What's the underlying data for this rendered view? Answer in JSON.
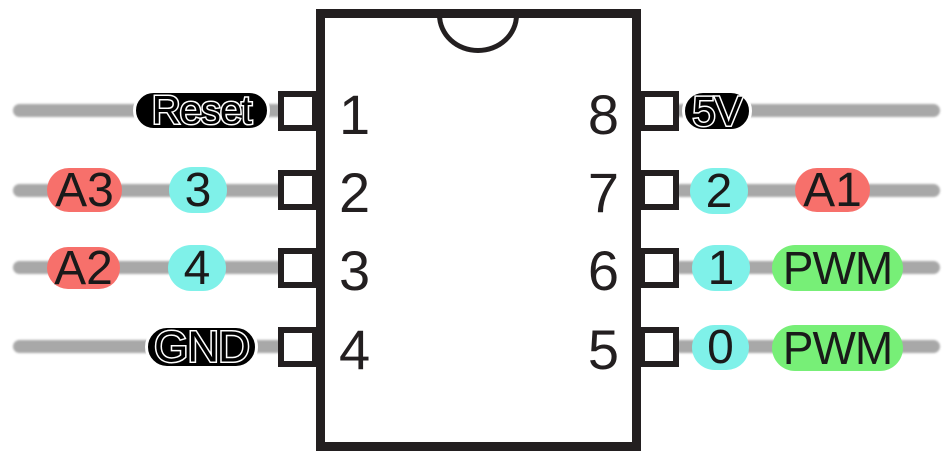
{
  "chip": {
    "pins": {
      "left": [
        {
          "number": "1",
          "labels": [
            {
              "text": "Reset",
              "style": "black"
            }
          ]
        },
        {
          "number": "2",
          "labels": [
            {
              "text": "A3",
              "style": "red"
            },
            {
              "text": "3",
              "style": "cyan"
            }
          ]
        },
        {
          "number": "3",
          "labels": [
            {
              "text": "A2",
              "style": "red"
            },
            {
              "text": "4",
              "style": "cyan"
            }
          ]
        },
        {
          "number": "4",
          "labels": [
            {
              "text": "GND",
              "style": "black"
            }
          ]
        }
      ],
      "right": [
        {
          "number": "8",
          "labels": [
            {
              "text": "5V",
              "style": "black"
            }
          ]
        },
        {
          "number": "7",
          "labels": [
            {
              "text": "2",
              "style": "cyan"
            },
            {
              "text": "A1",
              "style": "red"
            }
          ]
        },
        {
          "number": "6",
          "labels": [
            {
              "text": "1",
              "style": "cyan"
            },
            {
              "text": "PWM",
              "style": "green"
            }
          ]
        },
        {
          "number": "5",
          "labels": [
            {
              "text": "0",
              "style": "cyan"
            },
            {
              "text": "PWM",
              "style": "green"
            }
          ]
        }
      ]
    }
  },
  "colors": {
    "power_pill": "#000000",
    "analog_pill": "#f7706b",
    "digital_pill": "#7ff1e9",
    "pwm_pill": "#77ef77",
    "wire": "#a8a8a8",
    "chip_outline": "#231f20",
    "chip_fill": "#ffffff"
  }
}
